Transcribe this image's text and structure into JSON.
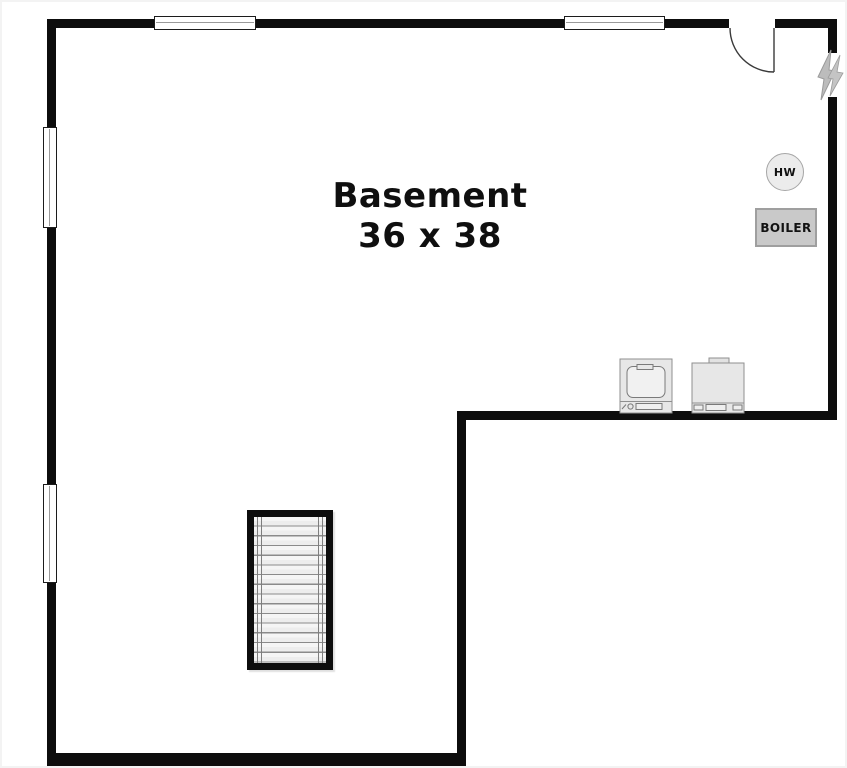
{
  "room": {
    "name": "Basement",
    "dimensions": "36 x 38"
  },
  "fixtures": {
    "hot_water": {
      "label": "HW",
      "type": "hot-water-heater"
    },
    "boiler": {
      "label": "BOILER"
    },
    "electrical": {
      "icon": "lightning-bolt",
      "location": "right-wall"
    },
    "laundry": {
      "washer_icon": "washer-top-load",
      "dryer_icon": "dryer"
    },
    "staircase": {
      "icon": "stairs",
      "treads": 15
    },
    "door": {
      "icon": "door-swing",
      "location": "top-right"
    },
    "windows": {
      "icon": "window",
      "count": 4
    }
  },
  "colors": {
    "wall": "#0d0d0d",
    "background": "#ffffff",
    "boiler_fill": "#c9c9c9",
    "hw_fill": "#ececec",
    "bolt_fill": "#bcbcbc",
    "stair_fill": "#f5f5f5",
    "appliance_fill": "#e7e7e7"
  }
}
